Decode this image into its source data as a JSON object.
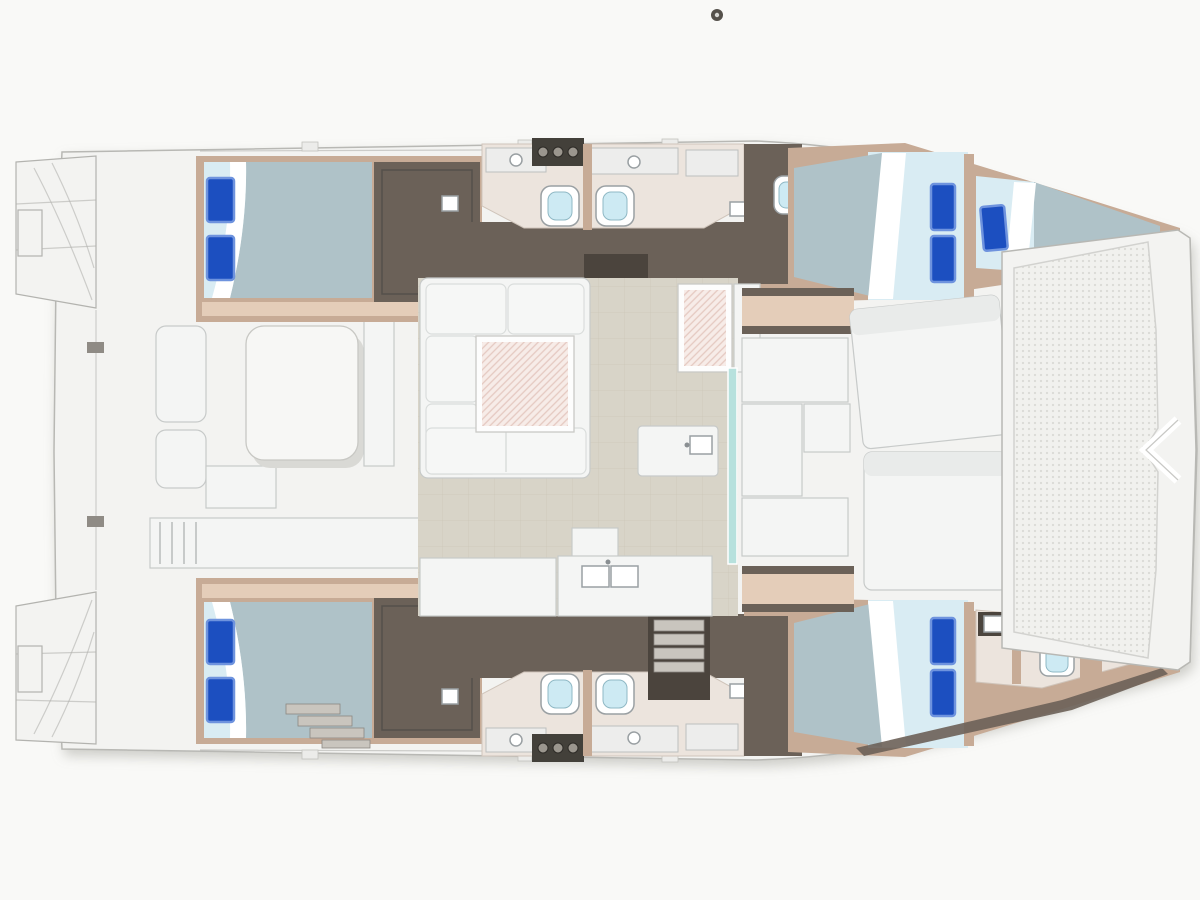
{
  "diagram": {
    "subject": "Catamaran sailing yacht deck and accommodation floor plan, top-down view",
    "orientation": {
      "bow": "right",
      "stern": "left",
      "port_hull": "top",
      "starboard_hull": "bottom"
    },
    "counts": {
      "cabins": 4,
      "double_beds": 4,
      "single_berths": 1,
      "blue_pillows": 9,
      "toilets": 6,
      "trampolines": 1
    },
    "stern": {
      "features": [
        "port swim platform with steps",
        "starboard swim platform with steps",
        "transom cleats"
      ]
    },
    "aft_cockpit": {
      "furniture": [
        "cockpit dining table",
        "side bench seats",
        "aft bench with slats",
        "lounge seats"
      ]
    },
    "salon": {
      "furniture": [
        "U-shaped settee",
        "hatched salon table",
        "chart table with hatched top",
        "chart bench",
        "galley island with sink",
        "aft galley counter with double sink",
        "companionway stairs to port hull",
        "companionway stairs to starboard hull",
        "tiled floor"
      ]
    },
    "forward_cockpit": {
      "furniture": [
        "sliding glass door",
        "two wood benches",
        "L-shaped lounge modules",
        "two large sun pads"
      ]
    },
    "foredeck": {
      "features": [
        "bow trampoline net",
        "bow bracket fitting",
        "port bow point",
        "starboard bow point"
      ]
    },
    "port_hull": {
      "aft_cabin": {
        "furniture": [
          "double bed",
          "2 blue pillows",
          "white folded sheet",
          "wardrobe"
        ]
      },
      "mid_heads": {
        "fixtures": [
          "2 toilets",
          "vanity counters with basins",
          "3-burner fixture",
          "wall divider"
        ]
      },
      "forward_head": {
        "fixtures": [
          "toilet"
        ]
      },
      "forward_cabin": {
        "furniture": [
          "double bed",
          "2 blue pillows",
          "single bow berth",
          "1 blue pillow"
        ]
      }
    },
    "starboard_hull": {
      "aft_cabin": {
        "furniture": [
          "double bed",
          "2 blue pillows",
          "white folded sheet",
          "wardrobe",
          "companionway steps"
        ]
      },
      "mid_heads": {
        "fixtures": [
          "2 toilets",
          "vanity counters with basins",
          "3-burner fixture",
          "wall divider"
        ]
      },
      "forward_cabin": {
        "furniture": [
          "double bed",
          "2 blue pillows",
          "washbasin unit"
        ]
      },
      "bow_head": {
        "fixtures": [
          "toilet"
        ]
      }
    }
  },
  "colors": {
    "page_bg": "#f9f9f7",
    "deck_white": "#f3f3f1",
    "deck_stroke": "#b8b8b4",
    "sketch_gray": "#b3b3af",
    "wood_tan": "#c7ab96",
    "wood_tan_light": "#e4cdb9",
    "heads_floor": "#ece4dd",
    "wall_dark": "#6b6158",
    "wall_dark2": "#4b443d",
    "bed_sheet": "#d9ecf3",
    "bed_duvet": "#afc2c8",
    "pillow_blue": "#1c4fc0",
    "pillow_edge": "#6e93de",
    "seat_white": "#f4f5f4",
    "seat_shadow": "#c7cac9",
    "cushion_line": "#dadddc",
    "water_blue": "#cdeaf3",
    "fixture_stroke": "#9aa0a3",
    "steps_gray": "#c9c5be",
    "floor_tile": "#d8d4c8",
    "tile_line": "#c3beae",
    "glass_teal": "#b7e1dd",
    "tramp_bg": "#f1f1ee",
    "tramp_dot": "#dbdbd6",
    "hatch_bg": "#f7ece8",
    "hatch_line": "#e5c9c1",
    "dark_fixture": "#43403a",
    "burner": "#9b968e"
  }
}
